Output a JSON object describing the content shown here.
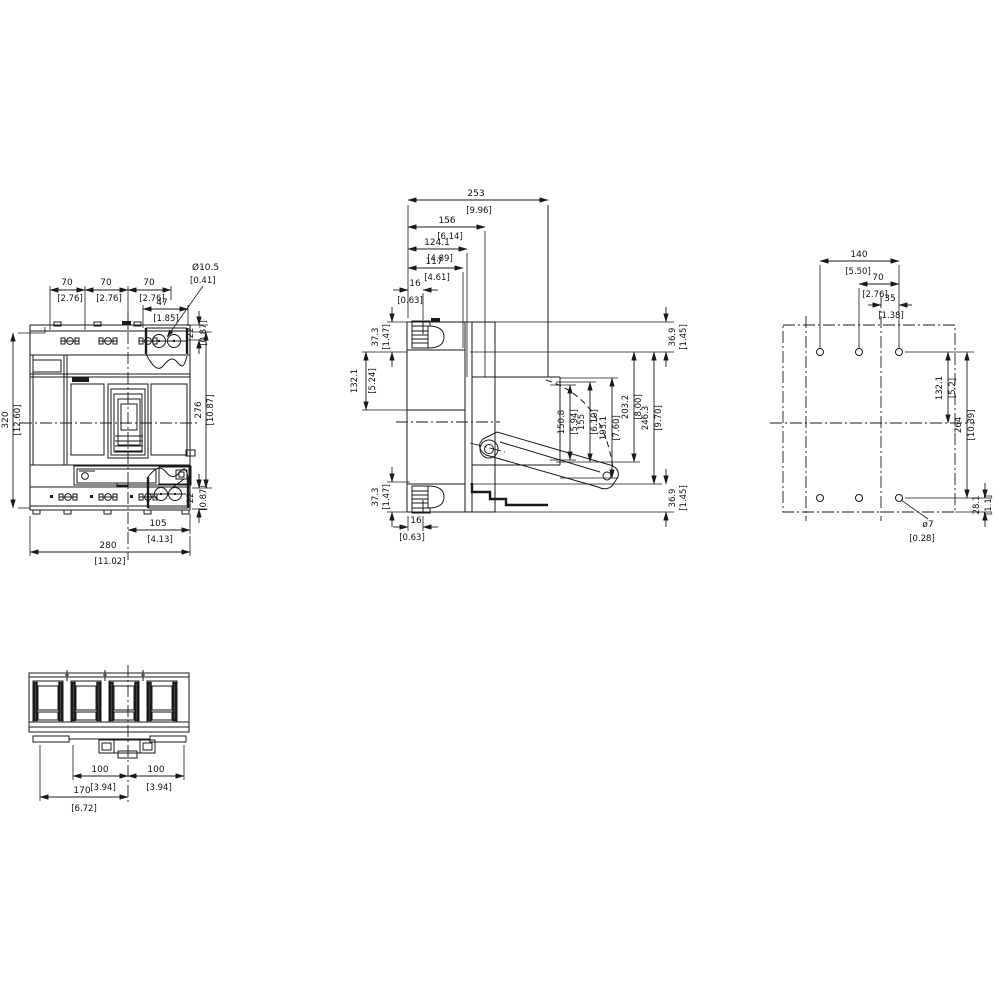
{
  "front": {
    "pitch_a": {
      "v": "70",
      "b": "[2.76]"
    },
    "pitch_b": {
      "v": "70",
      "b": "[2.76]"
    },
    "pitch_c": {
      "v": "70",
      "b": "[2.76]"
    },
    "d47": {
      "v": "47",
      "b": "[1.85]"
    },
    "hole": {
      "v": "Ø10.5",
      "b": "[0.41]"
    },
    "d22_top": {
      "v": "22",
      "b": "[0.87]"
    },
    "d22_bot": {
      "v": "22",
      "b": "[0.87]"
    },
    "h320": {
      "v": "320",
      "b": "[12.60]"
    },
    "h276": {
      "v": "276",
      "b": "[10.87]"
    },
    "w105": {
      "v": "105",
      "b": "[4.13]"
    },
    "w280": {
      "v": "280",
      "b": "[11.02]"
    }
  },
  "side": {
    "d253": {
      "v": "253",
      "b": "[9.96]"
    },
    "d156": {
      "v": "156",
      "b": "[6.14]"
    },
    "d124": {
      "v": "124.1",
      "b": "[4.89]"
    },
    "d117": {
      "v": "117",
      "b": "[4.61]"
    },
    "d16_top": {
      "v": "16",
      "b": "[0.63]"
    },
    "d16_bot": {
      "v": "16",
      "b": "[0.63]"
    },
    "d373_top": {
      "v": "37.3",
      "b": "[1.47]"
    },
    "d1321": {
      "v": "132.1",
      "b": "[5.24]"
    },
    "d373_bot": {
      "v": "37.3",
      "b": "[1.47]"
    },
    "d369_top": {
      "v": "36.9",
      "b": "[1.45]"
    },
    "d369_bot": {
      "v": "36.9",
      "b": "[1.45]"
    },
    "d1508": {
      "v": "150.8",
      "b": "[5.94]"
    },
    "d155": {
      "v": "155",
      "b": "[6.10]"
    },
    "d1931": {
      "v": "193.1",
      "b": "[7.60]"
    },
    "d2032": {
      "v": "203.2",
      "b": "[8.00]"
    },
    "d2463": {
      "v": "246.3",
      "b": "[9.70]"
    }
  },
  "rear": {
    "d140": {
      "v": "140",
      "b": "[5.50]"
    },
    "d70": {
      "v": "70",
      "b": "[2.76]"
    },
    "d35": {
      "v": "35",
      "b": "[1.38]"
    },
    "d1321": {
      "v": "132.1",
      "b": "[5.2]"
    },
    "d264": {
      "v": "264",
      "b": "[10.39]"
    },
    "d281": {
      "v": "28.1",
      "b": "[1.1]"
    },
    "hole": {
      "v": "ø7",
      "b": "[0.28]"
    }
  },
  "bottom": {
    "d100a": {
      "v": "100",
      "b": "[3.94]"
    },
    "d100b": {
      "v": "100",
      "b": "[3.94]"
    },
    "d170": {
      "v": "170",
      "b": "[6.72]"
    }
  }
}
